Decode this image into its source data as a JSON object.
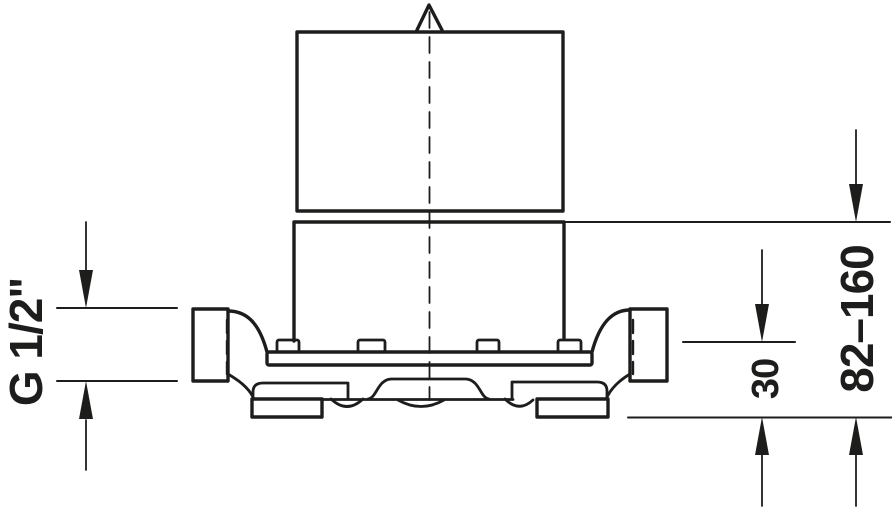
{
  "drawing": {
    "kind": "technical-dimension-drawing",
    "background_color": "#ffffff",
    "line_color": "#1d1d1b",
    "dimensions": {
      "thread": {
        "label": "G 1/2\"",
        "orientation": "rotated-90-ccw",
        "side": "left",
        "measures": "connection-port-height"
      },
      "depth": {
        "label": "30",
        "orientation": "rotated-90-ccw",
        "side": "right",
        "measures": "pipe-axis-to-reference-plane"
      },
      "range": {
        "label": "82–160",
        "orientation": "rotated-90-ccw",
        "side": "right",
        "measures": "sleeve-top-to-reference-plane"
      }
    }
  }
}
